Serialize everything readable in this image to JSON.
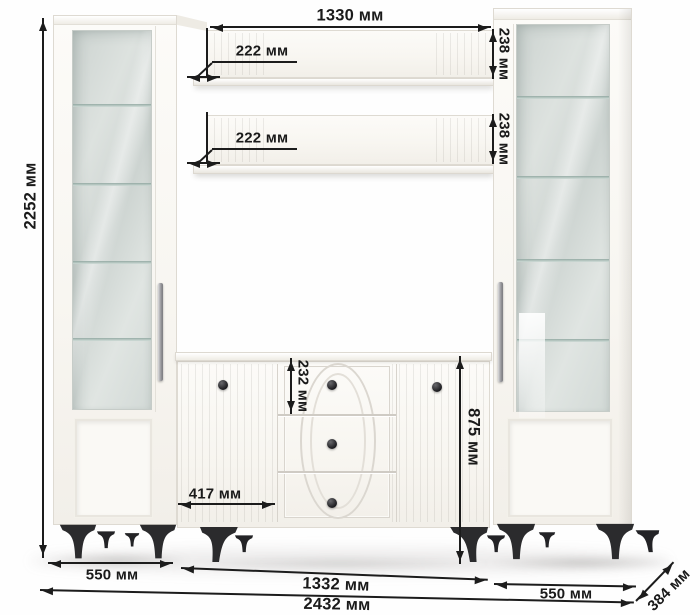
{
  "dims": {
    "shelf_length": "1330 мм",
    "total_height": "2252 мм",
    "shelf_depth_upper": "222 мм",
    "shelf_depth_lower": "222 мм",
    "shelf_face_upper": "238 мм",
    "shelf_face_lower": "238 мм",
    "top_drawer_height": "232 мм",
    "left_door_width": "417 мм",
    "sideboard_height": "875 мм",
    "left_cabinet_width": "550 мм",
    "sideboard_width": "1332 мм",
    "right_cabinet_width": "550 мм",
    "total_width": "2432 мм",
    "unit_depth": "384 мм"
  }
}
